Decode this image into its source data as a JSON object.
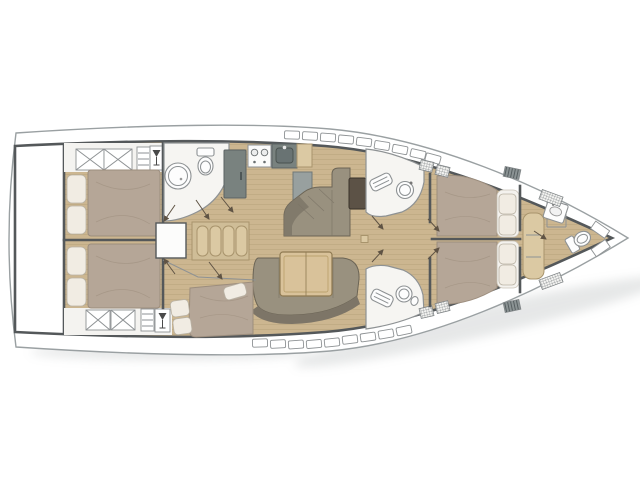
{
  "meta": {
    "title": "Sailing yacht interior layout plan, bow to the right, no visible text"
  },
  "colors": {
    "background": "#ffffff",
    "hull_outline": "#9aa0a2",
    "bulkhead": "#54585a",
    "wall_thin": "#8e9294",
    "wood_floor": "#ccb690",
    "wood_plank_line": "#b29c74",
    "wood_light": "#dbc9a3",
    "wood_table": "#d9c29a",
    "mattress": "#b5a697",
    "mattress_shade": "#9c8d7d",
    "pillow": "#f1ece3",
    "sofa": "#99917f",
    "sofa_back": "#7d7567",
    "galley_counter": "#98a09f",
    "appliance_dark": "#79827f",
    "sink_dark": "#697373",
    "chart_table_dark": "#5c5246",
    "room_white": "#f6f5f2",
    "fixture_white": "#fdfdfd",
    "hatch_line": "#7f8486",
    "arrow": "#5f5344",
    "shadow": "#aeb3b4"
  },
  "regions": [
    {
      "id": "swim-platform",
      "name": "transom / stern platform"
    },
    {
      "id": "aft-cabin-top",
      "name": "aft double cabin (top side)"
    },
    {
      "id": "aft-cabin-bottom",
      "name": "aft double cabin (bottom side)"
    },
    {
      "id": "mid-cabin",
      "name": "mid double cabin (bottom side)"
    },
    {
      "id": "companionway",
      "name": "companionway steps"
    },
    {
      "id": "head-aft",
      "name": "aft head with shower and toilet"
    },
    {
      "id": "galley",
      "name": "galley with fridge, stove and sink"
    },
    {
      "id": "salon",
      "name": "salon with settee and folding table"
    },
    {
      "id": "chart-area",
      "name": "chaise settee with chart table"
    },
    {
      "id": "head-mid-top",
      "name": "mid head (top side)"
    },
    {
      "id": "head-mid-bottom",
      "name": "mid head (bottom side)"
    },
    {
      "id": "fwd-cabin-top",
      "name": "forward double cabin (top side)"
    },
    {
      "id": "fwd-cabin-bottom",
      "name": "forward double cabin (bottom side)"
    },
    {
      "id": "bow-head",
      "name": "bow head with sink and toilet"
    }
  ],
  "fixtures": [
    "double-bed",
    "pillow",
    "wardrobe-cross-locker",
    "wet-bar-glass-icon",
    "companionway-steps",
    "shower",
    "toilet",
    "sink",
    "stove-burners",
    "fridge",
    "settee",
    "salon-table",
    "chart-table",
    "mast-post",
    "deck-hatch",
    "hull-window",
    "door-swing-arrow"
  ]
}
